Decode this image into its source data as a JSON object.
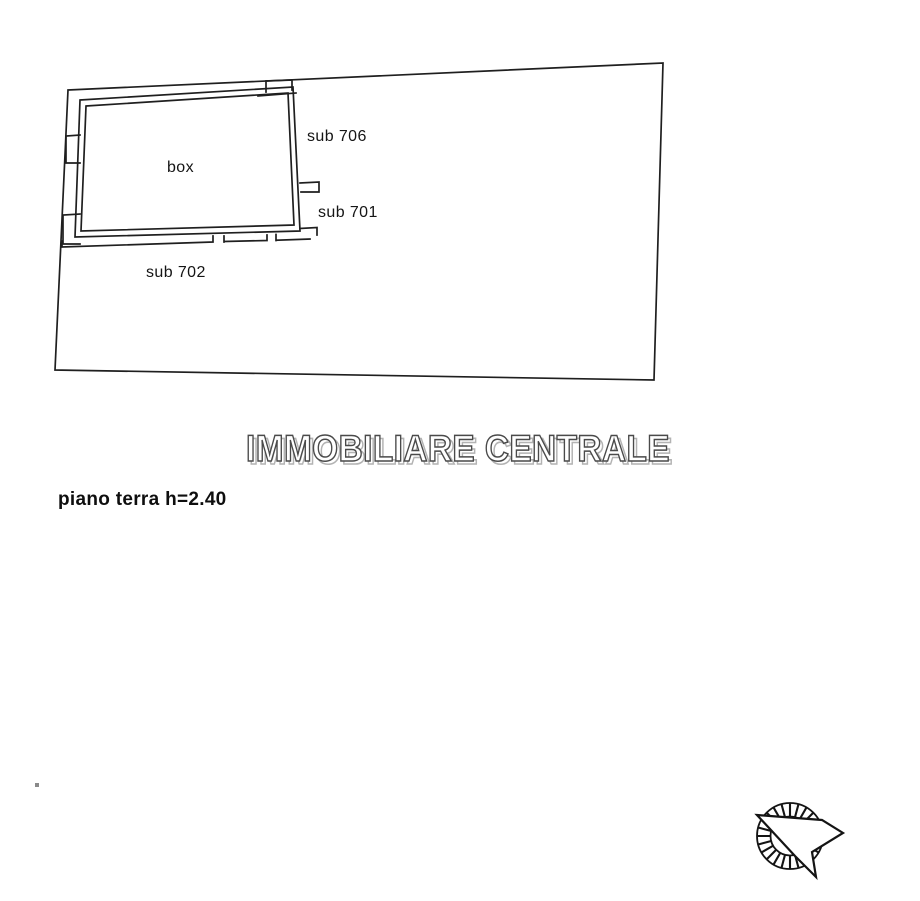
{
  "plan": {
    "room_labels": {
      "box": "box",
      "sub_706": "sub 706",
      "sub_701": "sub 701",
      "sub_702": "sub 702"
    },
    "floor_text": "piano terra h=2.40",
    "watermark_text": "IMMOBILIARE CENTRALE",
    "icons": {
      "north_arrow": "north-arrow-compass"
    },
    "colors": {
      "line": "#1f1f1f",
      "background": "#ffffff",
      "watermark_fill": "#ffffff",
      "watermark_outline": "#4a4a4a",
      "watermark_shadow": "#b3b3b3"
    }
  }
}
